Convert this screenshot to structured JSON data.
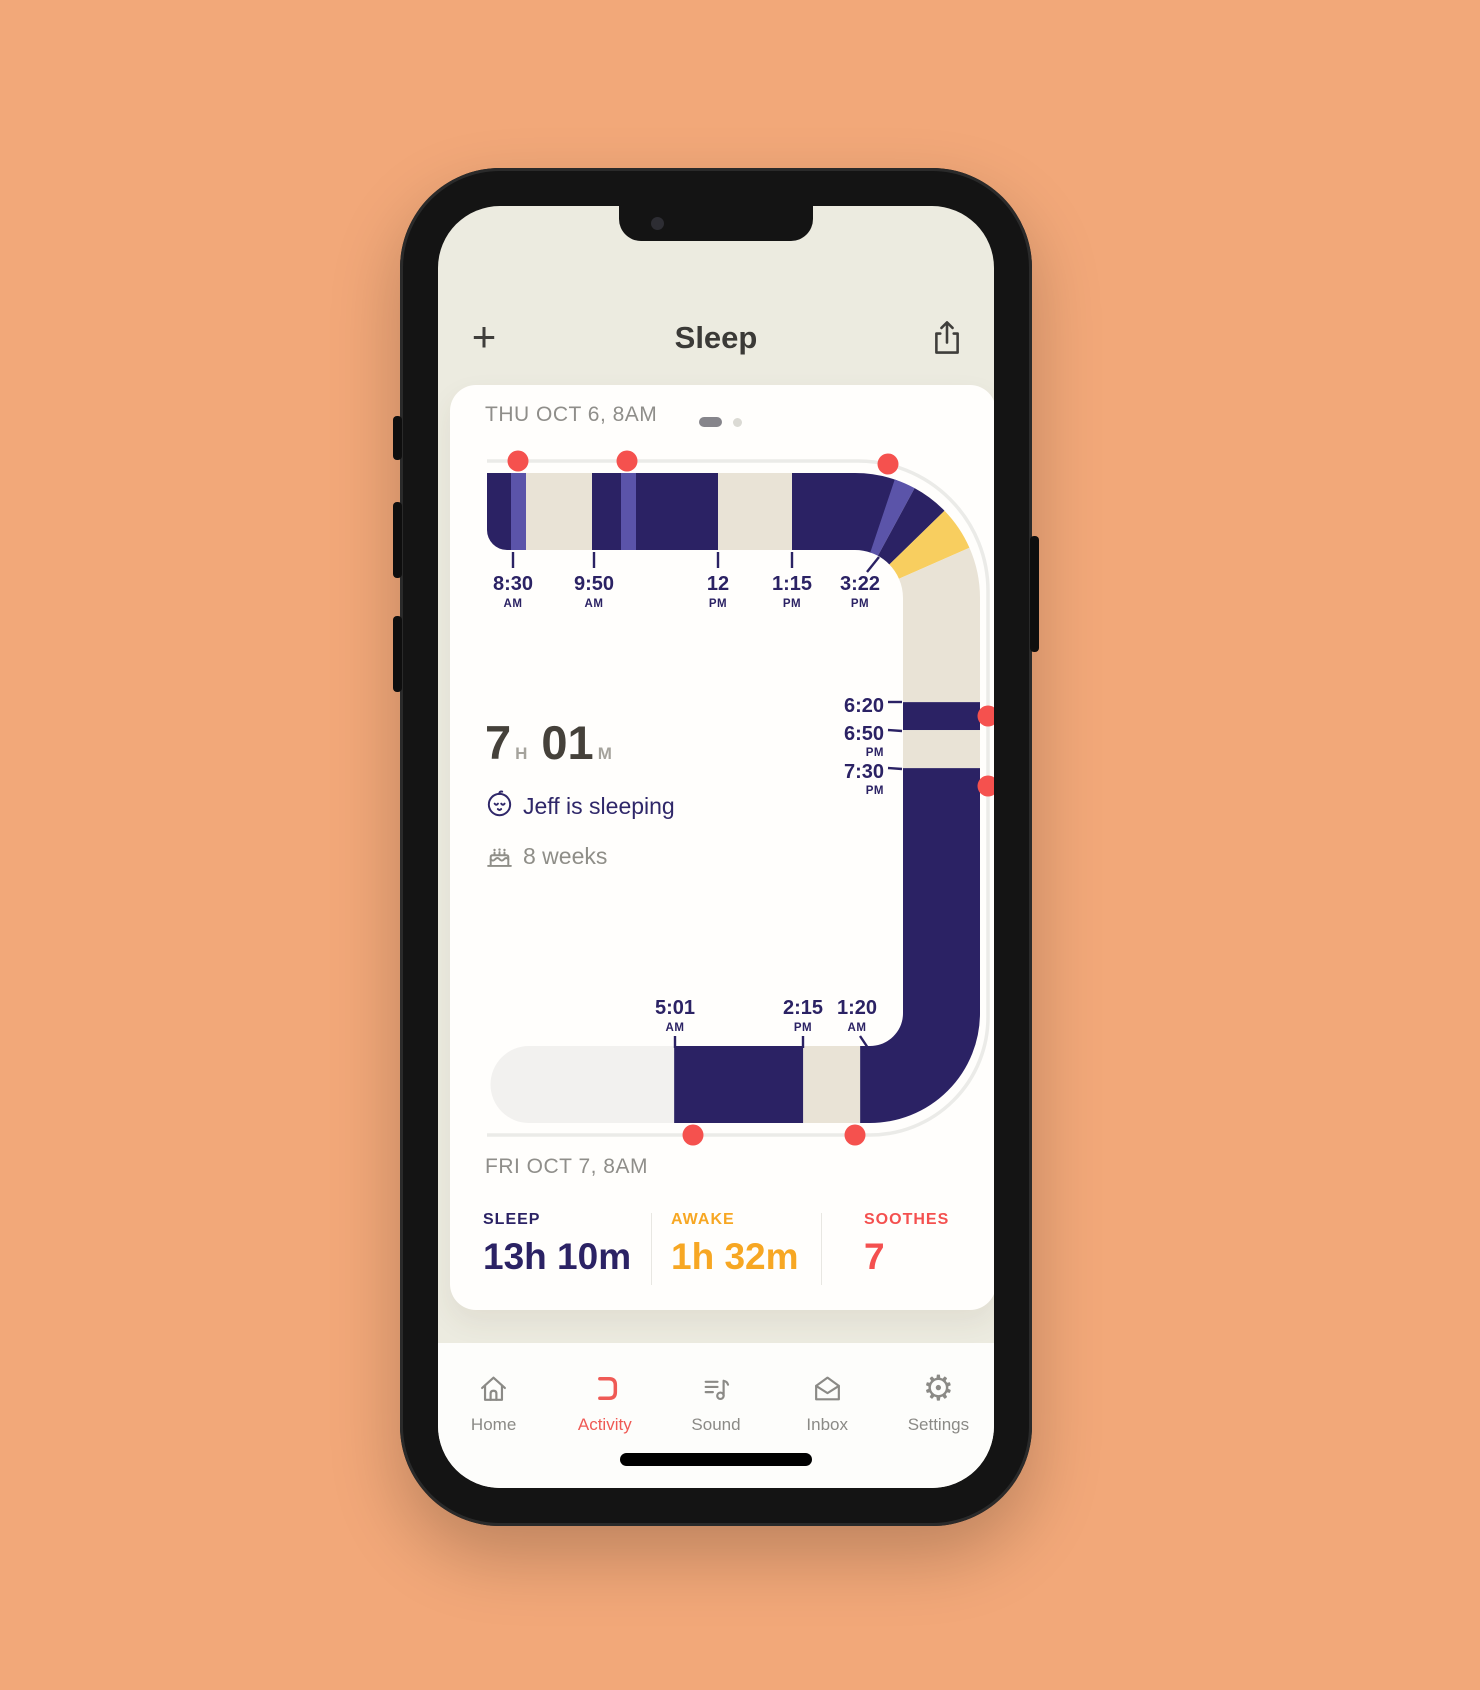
{
  "header": {
    "add_label": "+",
    "title": "Sleep"
  },
  "card": {
    "date_top": "THU OCT 6, 8AM",
    "date_bottom": "FRI OCT 7, 8AM",
    "pager": {
      "pages": 2,
      "active_index": 0
    },
    "summary": {
      "hours": "7",
      "hours_unit": "H",
      "minutes": "01",
      "minutes_unit": "M",
      "status": "Jeff is sleeping",
      "age": "8 weeks"
    },
    "stats": [
      {
        "label": "SLEEP",
        "value": "13h 10m",
        "color": "#2b2264"
      },
      {
        "label": "AWAKE",
        "value": "1h 32m",
        "color": "#f7a723"
      },
      {
        "label": "SOOTHES",
        "value": "7",
        "color": "#f4504f"
      }
    ]
  },
  "chart_data": {
    "type": "area",
    "title": "24h sleep timeline from THU OCT 6 8AM to FRI OCT 7 8AM",
    "colors": {
      "sleep": "#2b2264",
      "soothe_stripe": "#5b54a9",
      "awake": "#e9e3d6",
      "awake_crib": "#f8ce5f",
      "future": "#f2f1ef",
      "marker": "#f5514e",
      "guideline": "#ebebe8",
      "tick_text": "#2b2264"
    },
    "segments": [
      {
        "start": 0,
        "end": 27,
        "kind": "sleep"
      },
      {
        "start": 24,
        "end": 39,
        "kind": "soothe_stripe"
      },
      {
        "start": 39,
        "end": 105,
        "kind": "awake"
      },
      {
        "start": 105,
        "end": 137,
        "kind": "sleep"
      },
      {
        "start": 134,
        "end": 149,
        "kind": "soothe_stripe"
      },
      {
        "start": 149,
        "end": 231,
        "kind": "sleep"
      },
      {
        "start": 231,
        "end": 305,
        "kind": "awake"
      },
      {
        "start": 305,
        "end": 398,
        "kind": "sleep"
      },
      {
        "start": 396,
        "end": 411,
        "kind": "soothe_stripe"
      },
      {
        "start": 411,
        "end": 437,
        "kind": "sleep"
      },
      {
        "start": 437,
        "end": 468,
        "kind": "awake_crib"
      },
      {
        "start": 468,
        "end": 608,
        "kind": "awake"
      },
      {
        "start": 608,
        "end": 636,
        "kind": "sleep"
      },
      {
        "start": 636,
        "end": 674,
        "kind": "awake"
      },
      {
        "start": 674,
        "end": 1041,
        "kind": "sleep"
      },
      {
        "start": 1041,
        "end": 1098,
        "kind": "awake"
      },
      {
        "start": 1098,
        "end": 1227,
        "kind": "sleep"
      },
      {
        "start": 1227,
        "end": 1416,
        "kind": "future"
      }
    ],
    "top_ticks": [
      {
        "time": "8:30",
        "unit": "AM",
        "line": [
          513,
          552,
          513,
          568
        ],
        "label": [
          513,
          590
        ]
      },
      {
        "time": "9:50",
        "unit": "AM",
        "line": [
          594,
          552,
          594,
          568
        ],
        "label": [
          594,
          590
        ]
      },
      {
        "time": "12",
        "unit": "PM",
        "line": [
          718,
          552,
          718,
          568
        ],
        "label": [
          718,
          590
        ]
      },
      {
        "time": "1:15",
        "unit": "PM",
        "line": [
          792,
          552,
          792,
          568
        ],
        "label": [
          792,
          590
        ]
      },
      {
        "time": "3:22",
        "unit": "PM",
        "line": [
          879,
          557,
          867,
          572
        ],
        "label": [
          860,
          590
        ]
      }
    ],
    "right_ticks": [
      {
        "time": "6:20",
        "unit": "",
        "line": [
          888,
          702,
          902,
          702
        ],
        "label": [
          884,
          712
        ]
      },
      {
        "time": "6:50",
        "unit": "PM",
        "line": [
          888,
          730,
          902,
          731
        ],
        "label": [
          884,
          740
        ]
      },
      {
        "time": "7:30",
        "unit": "PM",
        "line": [
          888,
          768,
          902,
          769
        ],
        "label": [
          884,
          778
        ]
      }
    ],
    "bottom_ticks": [
      {
        "time": "5:01",
        "unit": "AM",
        "line": [
          675,
          1036,
          675,
          1048
        ],
        "label": [
          675,
          1014
        ]
      },
      {
        "time": "2:15",
        "unit": "PM",
        "line": [
          803,
          1036,
          803,
          1048
        ],
        "label": [
          803,
          1014
        ]
      },
      {
        "time": "1:20",
        "unit": "AM",
        "line": [
          860,
          1036,
          868,
          1048
        ],
        "label": [
          857,
          1014
        ]
      }
    ],
    "soothe_dots": [
      [
        518,
        461
      ],
      [
        627,
        461
      ],
      [
        888,
        464
      ],
      [
        988,
        716
      ],
      [
        988,
        786
      ],
      [
        693,
        1135
      ],
      [
        855,
        1135
      ]
    ]
  },
  "nav": {
    "items": [
      {
        "label": "Home",
        "icon": "home-icon",
        "active": false
      },
      {
        "label": "Activity",
        "icon": "activity-icon",
        "active": true
      },
      {
        "label": "Sound",
        "icon": "sound-icon",
        "active": false
      },
      {
        "label": "Inbox",
        "icon": "inbox-icon",
        "active": false
      },
      {
        "label": "Settings",
        "icon": "gear-icon",
        "active": false
      }
    ]
  }
}
